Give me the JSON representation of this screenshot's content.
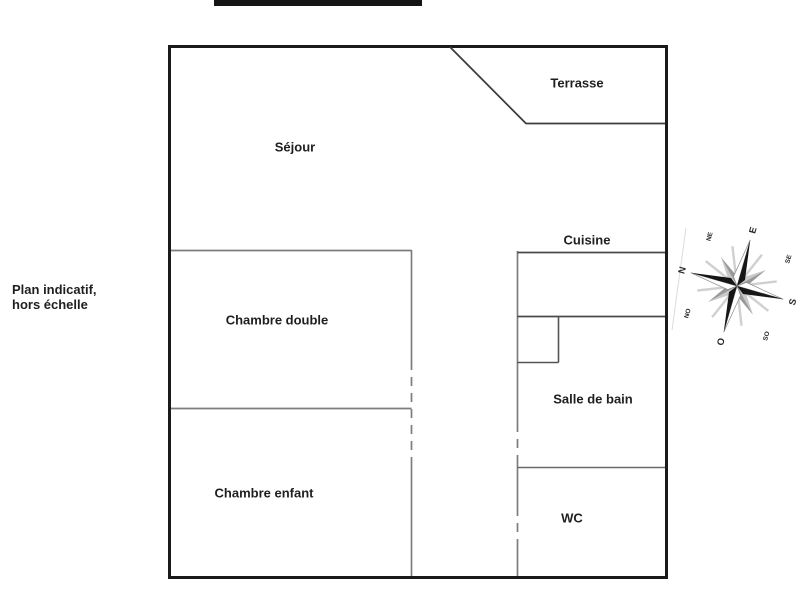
{
  "note": {
    "line1": "Plan indicatif,",
    "line2": "hors échelle"
  },
  "rooms": {
    "terrasse": "Terrasse",
    "sejour": "Séjour",
    "cuisine": "Cuisine",
    "chambre_double": "Chambre double",
    "salle_de_bain": "Salle de bain",
    "chambre_enfant": "Chambre enfant",
    "wc": "WC"
  },
  "compass": {
    "n": "N",
    "ne": "NE",
    "e": "E",
    "se": "SE",
    "s": "S",
    "so": "SO",
    "o": "O",
    "no": "NO"
  },
  "colors": {
    "outer_wall": "#1a1a1a",
    "terrace_wall": "#3c3c3c",
    "interior_wall": "#7d7d7d",
    "kitchen_fixture": "#4a4a4a",
    "text": "#1f1f1f",
    "redaction_bar": "#141414",
    "compass_dark": "#161616",
    "compass_gray": "#9a9a9a"
  }
}
